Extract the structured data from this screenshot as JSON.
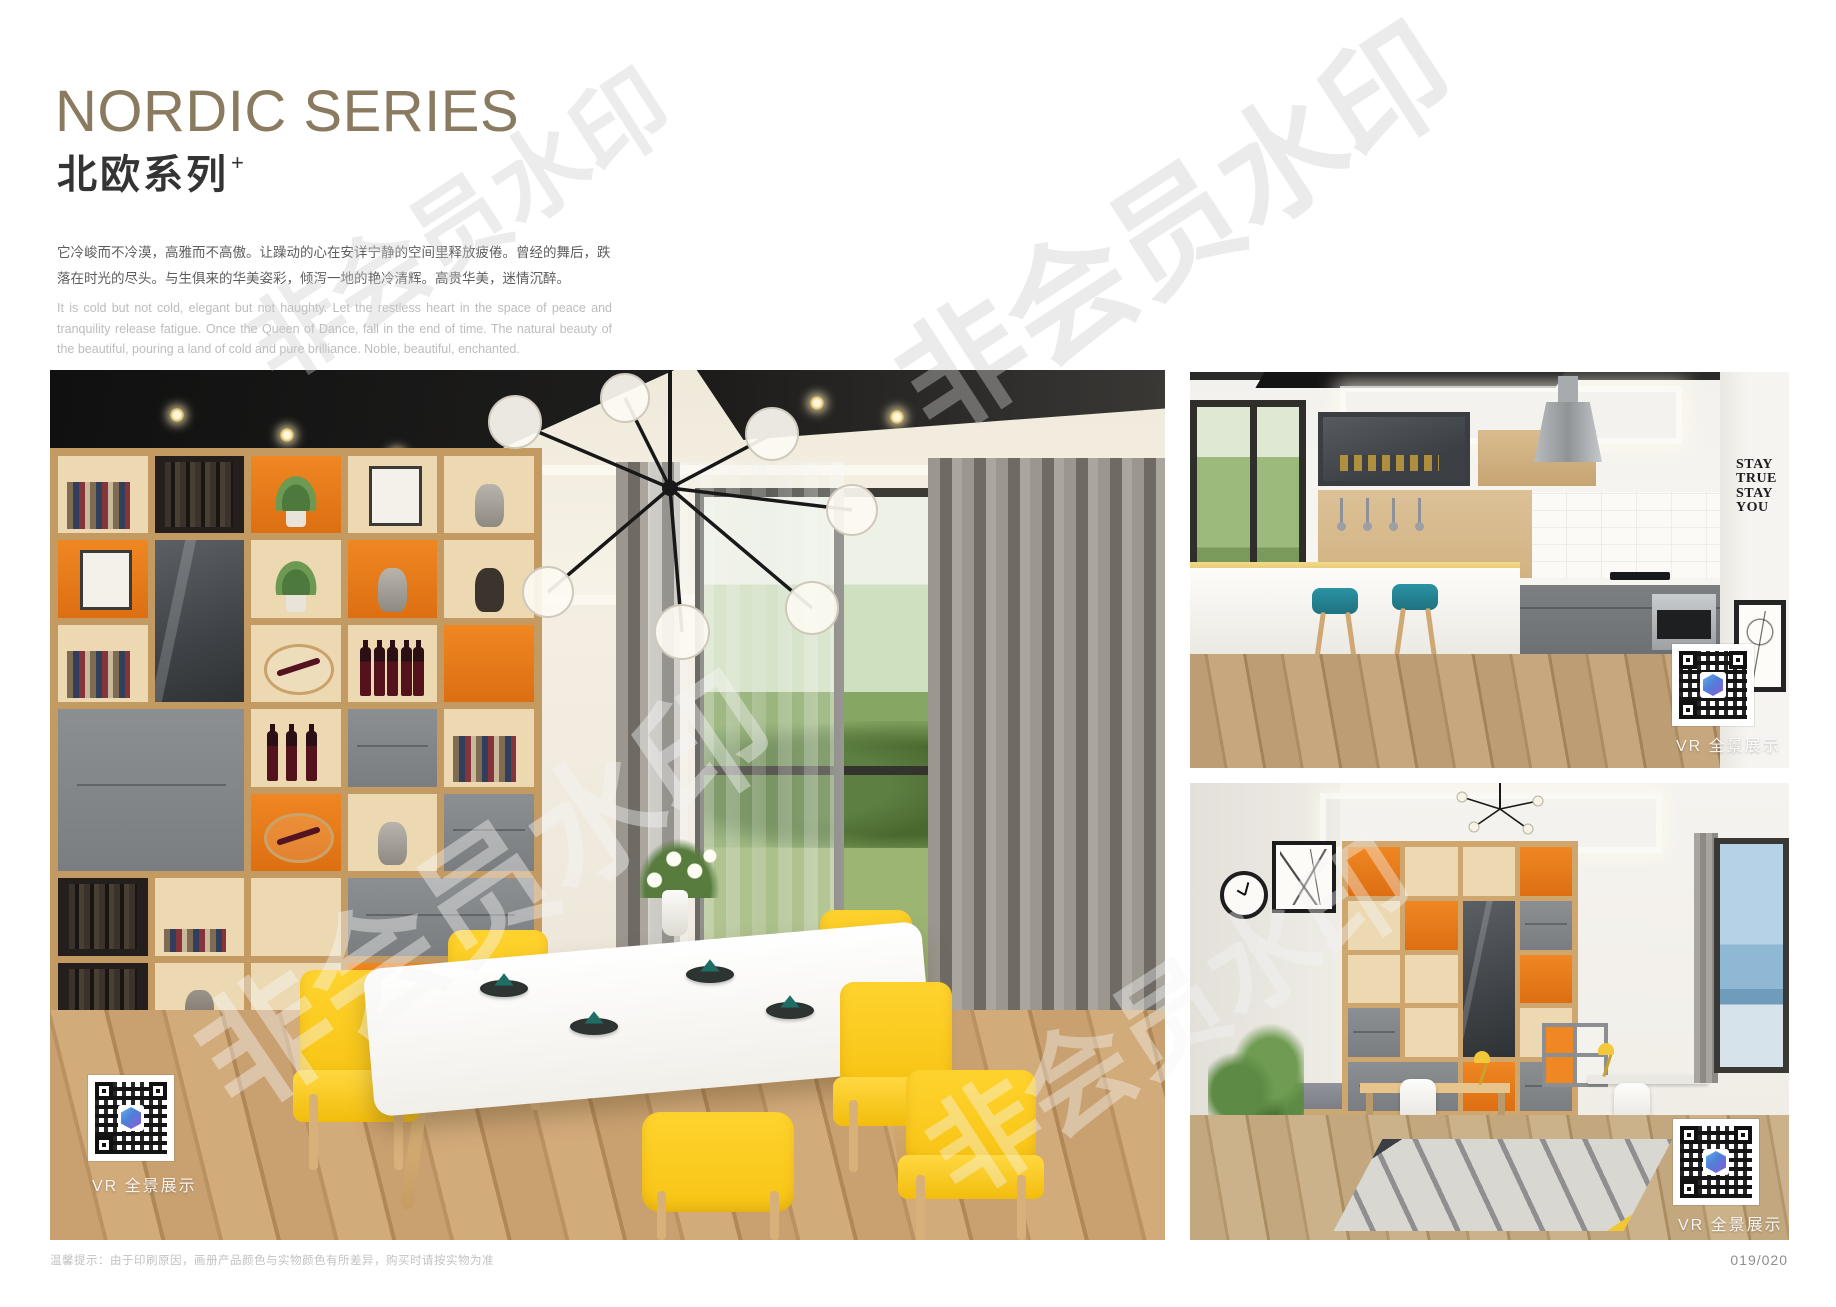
{
  "header": {
    "title_en": "NORDIC SERIES",
    "title_zh": "北欧系列",
    "title_superscript": "+",
    "intro_zh": "它冷峻而不冷漠，高雅而不高傲。让躁动的心在安详宁静的空间里释放疲倦。曾经的舞后，跌落在时光的尽头。与生俱来的华美姿彩，倾泻一地的艳冷清辉。高贵华美，迷情沉醉。",
    "intro_en": "It is cold but not cold, elegant but not haughty. Let the restless heart in the space of peace and tranquility release fatigue. Once the Queen of Dance, fall in the end of time. The natural beauty of the beautiful, pouring a land of cold and pure brilliance. Noble, beautiful, enchanted."
  },
  "watermark": {
    "text": "非会员水印"
  },
  "gallery": {
    "dining": {
      "name": "dining-room-photo",
      "caption": "VR 全景展示"
    },
    "kitchen": {
      "name": "kitchen-photo",
      "caption": "VR 全景展示",
      "wall_decal": [
        "STAY",
        "TRUE",
        "STAY",
        "YOU"
      ]
    },
    "study": {
      "name": "study-room-photo",
      "caption": "VR 全景展示"
    }
  },
  "footer": {
    "disclaimer": "温馨提示：由于印刷原因，画册产品颜色与实物颜色有所差异，购买时请按实物为准",
    "page_number": "019/020"
  },
  "colors": {
    "title_bronze": "#8a7a5f",
    "accent_orange": "#e8791e",
    "chair_yellow": "#ffd32e",
    "stool_teal": "#2a93a3",
    "cabinet_gray": "#85898c",
    "wood": "#d2ab7a"
  }
}
